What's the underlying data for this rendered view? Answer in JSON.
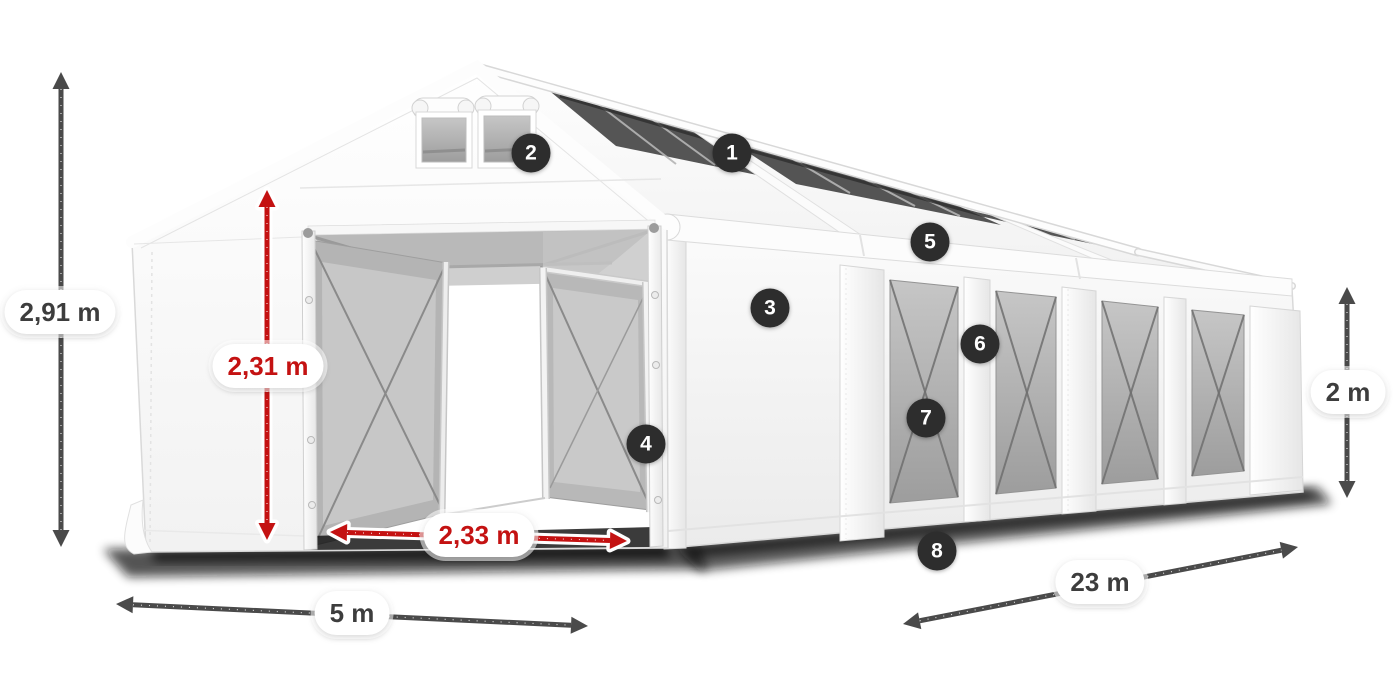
{
  "illustration": {
    "subject": "marquee-tent-dimensions",
    "colors": {
      "arrow_dark": "#4a4a4a",
      "arrow_red": "#c41212",
      "badge_bg": "#2d2d2d",
      "badge_text": "#ffffff",
      "label_bg": "#ffffff",
      "label_text_dark": "#3d3d3d",
      "label_text_red": "#c41212"
    },
    "badges": [
      {
        "label": "1"
      },
      {
        "label": "2"
      },
      {
        "label": "3"
      },
      {
        "label": "4"
      },
      {
        "label": "5"
      },
      {
        "label": "6"
      },
      {
        "label": "7"
      },
      {
        "label": "8"
      }
    ],
    "dimensions": {
      "total_height": {
        "value": "2,91 m"
      },
      "entrance_height": {
        "value": "2,31 m"
      },
      "entrance_width": {
        "value": "2,33 m"
      },
      "gable_width": {
        "value": "5 m"
      },
      "length": {
        "value": "23 m"
      },
      "side_height": {
        "value": "2 m"
      }
    }
  }
}
